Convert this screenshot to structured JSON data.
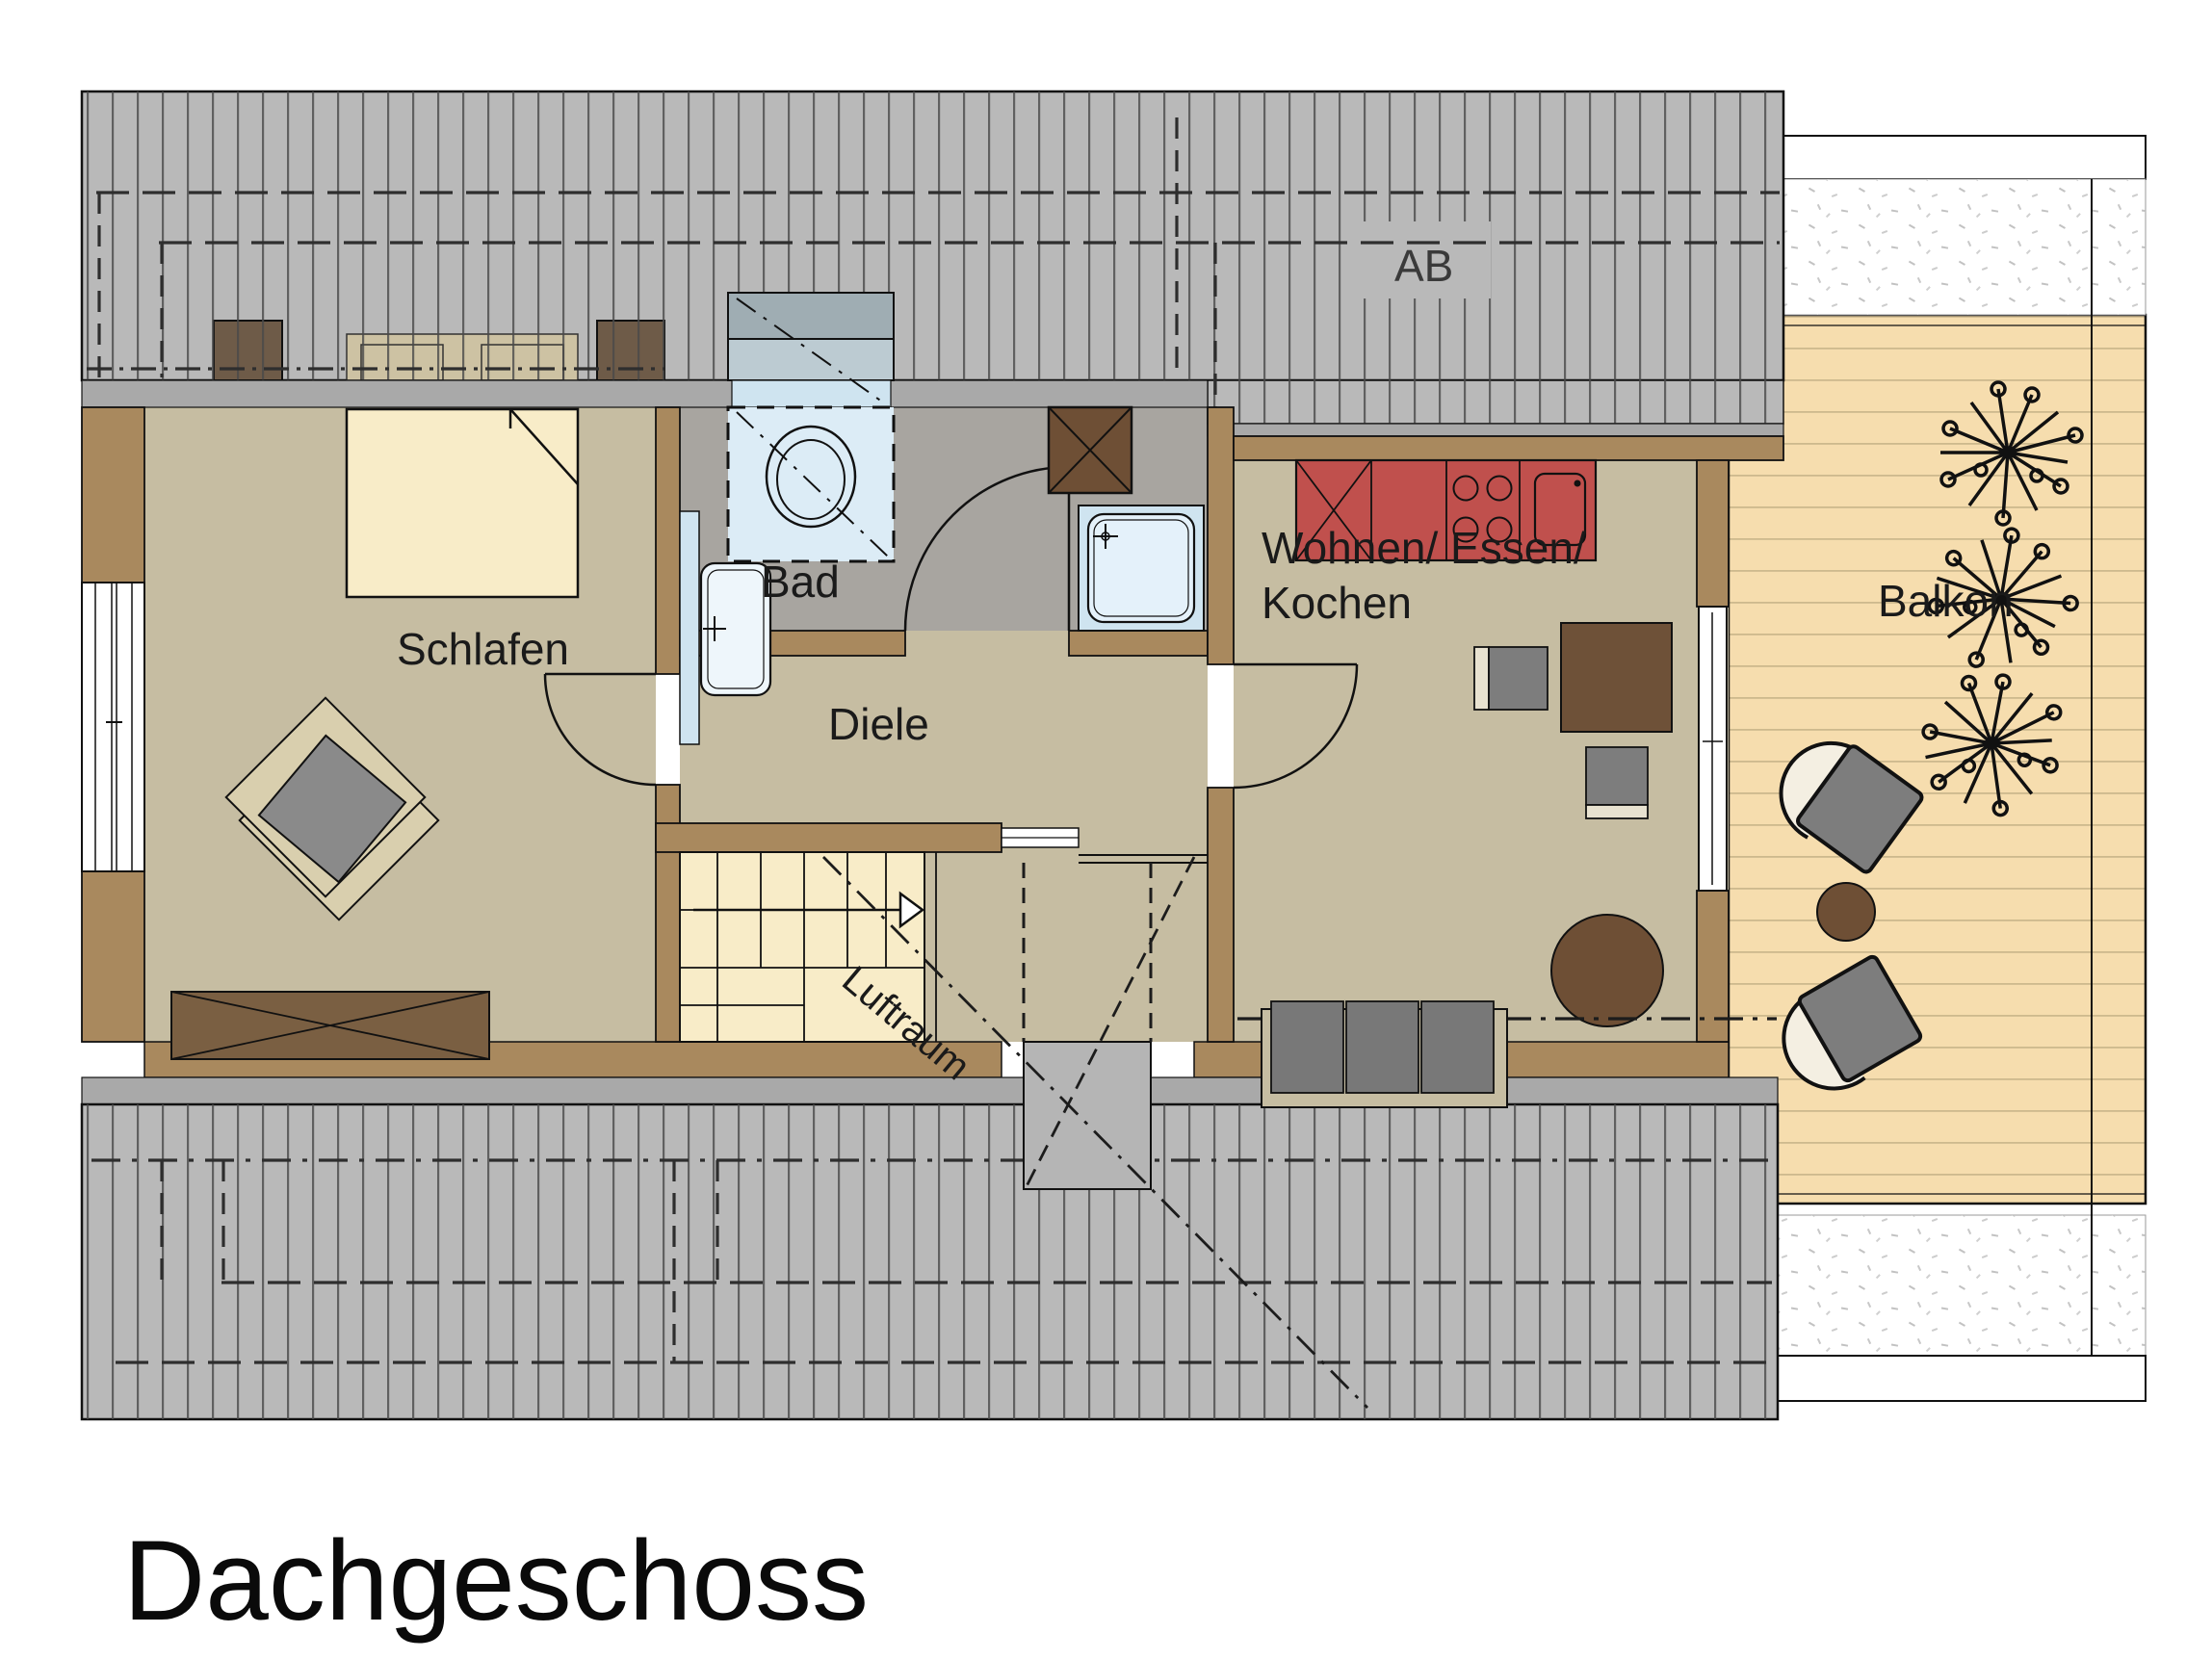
{
  "title": "Dachgeschoss",
  "floor_plan": {
    "rooms": {
      "schlafen": {
        "label": "Schlafen"
      },
      "bad": {
        "label": "Bad"
      },
      "diele": {
        "label": "Diele"
      },
      "wohnen": {
        "label_line1": "Wohnen/ Essen/",
        "label_line2": "Kochen"
      },
      "balkon": {
        "label": "Balkon"
      },
      "luftraum": {
        "label": "Luftraum"
      },
      "roof_section": {
        "label": "AB"
      }
    },
    "fixtures": [
      "bed",
      "wardrobe-dresser",
      "armchair",
      "toilet",
      "washbasin",
      "shower",
      "chimney-shaft",
      "kitchen-counter",
      "cooktop",
      "kitchen-sink",
      "dining-table",
      "dining-chairs",
      "round-table",
      "sofa",
      "staircase",
      "balcony-chairs",
      "balcony-table",
      "plants"
    ],
    "colors": {
      "roof_hatch": "#b9b9b9",
      "roof_line": "#4a4a4a",
      "wall_brown": "#a9895e",
      "floor_tan": "#c6bda2",
      "bath_floor": "#a8a5a0",
      "fixture_blue": "#cfe4f0",
      "counter_red": "#c0504d",
      "furniture_dark_brown": "#6e4f35",
      "furniture_gray": "#7d7d7d",
      "bed_cream": "#f8ecc8",
      "deck_wood": "#f6ddae"
    }
  }
}
